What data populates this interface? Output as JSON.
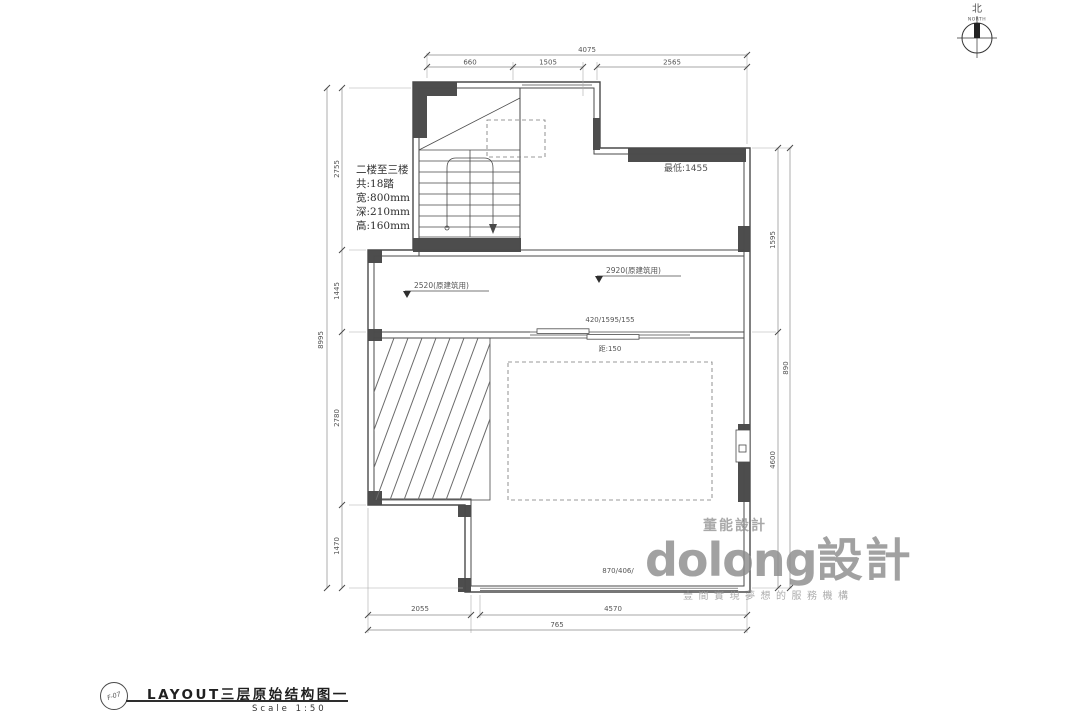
{
  "drawing": {
    "stair_note": {
      "line1": "二楼至三楼",
      "line2": "共:18踏",
      "line3": "宽:800mm",
      "line4": "深:210mm",
      "line5": "高:160mm"
    },
    "annotations": {
      "lowest": "最低:1455",
      "level_left": "2520(原建筑用)",
      "level_right": "2920(原建筑用)",
      "window_mid_top": "420/1595/155",
      "window_mid_bottom": "距:150",
      "window_bottom": "870/406/"
    },
    "dims": {
      "top": {
        "total": "4075",
        "seg1": "660",
        "seg2": "1505",
        "seg3": "2565"
      },
      "left": {
        "total": "8995",
        "seg1": "2755",
        "seg2": "1445",
        "seg3": "2780",
        "seg4": "1470"
      },
      "right": {
        "total": "890",
        "seg1": "1595",
        "seg2": "4600"
      },
      "bottom": {
        "total": "765",
        "seg1": "2055",
        "seg2": "4570"
      }
    }
  },
  "north_arrow": {
    "cn": "北",
    "en": "NORTH"
  },
  "watermark": {
    "small": "董能設計",
    "brand": "dolong",
    "brand_suffix": "設計",
    "tagline": "壹間實現夢想的服務機構"
  },
  "title_block": {
    "code": "F-07",
    "title": "LAYOUT三层原始结构图一",
    "scale": "Scale 1:50"
  },
  "colors": {
    "wall_fill": "#4d4d4d",
    "wall_line": "#4a4a4a",
    "dim_line": "#8a8a8a",
    "text": "#555555",
    "watermark": "#8f8f8f"
  }
}
